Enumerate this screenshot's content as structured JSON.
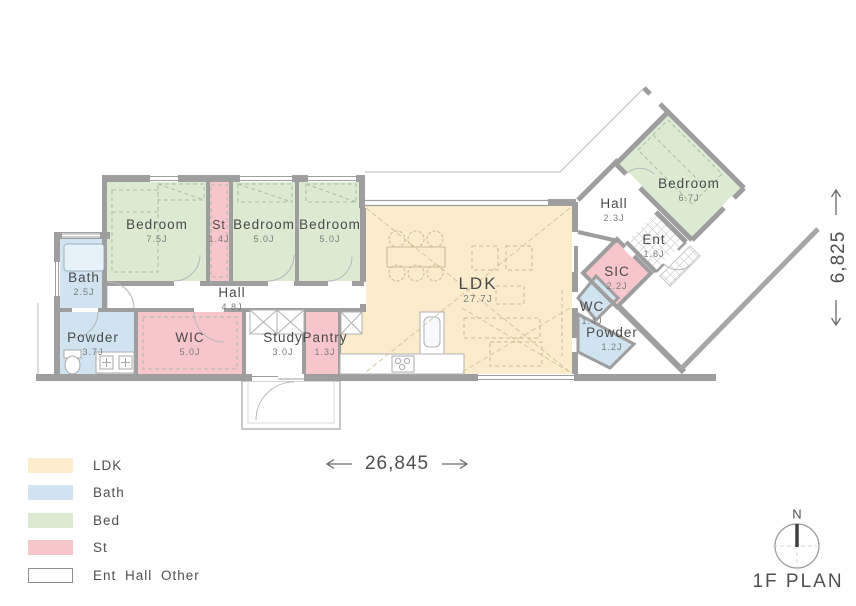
{
  "title": {
    "text": "1F PLAN"
  },
  "compass": {
    "north_label": "N"
  },
  "dimensions": {
    "width_label": "26,845",
    "height_label": "6,825"
  },
  "legend": {
    "items": [
      {
        "key": "ldk",
        "label": "LDK",
        "color": "#faeccd"
      },
      {
        "key": "bath",
        "label": "Bath",
        "color": "#cfe3f0"
      },
      {
        "key": "bed",
        "label": "Bed",
        "color": "#dcead2"
      },
      {
        "key": "st",
        "label": "St",
        "color": "#f6c6cb"
      },
      {
        "key": "other",
        "label": "Ent Hall Other",
        "color": "#ffffff"
      }
    ]
  },
  "rooms": {
    "bedroom1": {
      "name": "Bedroom",
      "area": "7.5J"
    },
    "st": {
      "name": "St",
      "area": "1.4J"
    },
    "bedroom2": {
      "name": "Bedroom",
      "area": "5.0J"
    },
    "bedroom3": {
      "name": "Bedroom",
      "area": "5.0J"
    },
    "bath": {
      "name": "Bath",
      "area": "2.5J"
    },
    "hall": {
      "name": "Hall",
      "area": "4.8J"
    },
    "powder": {
      "name": "Powder",
      "area": "3.7J"
    },
    "wic": {
      "name": "WIC",
      "area": "5.0J"
    },
    "study": {
      "name": "Study",
      "area": "3.0J"
    },
    "pantry": {
      "name": "Pantry",
      "area": "1.3J"
    },
    "ldk": {
      "name": "LDK",
      "area": "27.7J"
    },
    "hall2": {
      "name": "Hall",
      "area": "2.3J"
    },
    "ent": {
      "name": "Ent",
      "area": "1.6J"
    },
    "sic": {
      "name": "SIC",
      "area": "2.2J"
    },
    "wc": {
      "name": "WC",
      "area": "1.4J"
    },
    "powder2": {
      "name": "Powder",
      "area": "1.2J"
    },
    "bedroom4": {
      "name": "Bedroom",
      "area": "6.7J"
    }
  },
  "colors": {
    "wall": "#9e9e9e",
    "floor_ldk": "#faeccd",
    "floor_bath": "#cfe3f0",
    "floor_bed": "#dcead2",
    "floor_st": "#f6c6cb",
    "text": "#4a4a4a"
  }
}
